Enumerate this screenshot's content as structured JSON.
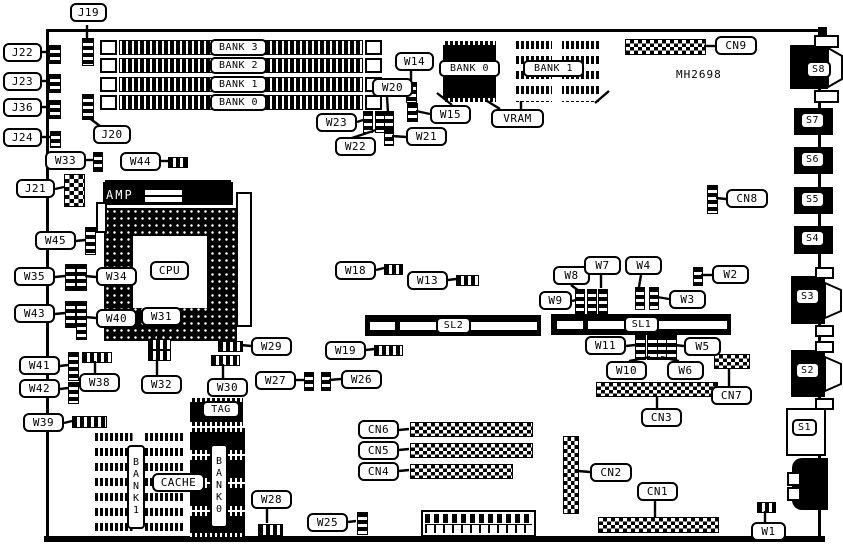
{
  "board": {
    "model": "MH2698"
  },
  "colors": {
    "foreground": "#000000",
    "background": "#ffffff"
  },
  "labels": {
    "j19": "J19",
    "j20": "J20",
    "j21": "J21",
    "j22": "J22",
    "j23": "J23",
    "j24": "J24",
    "j36": "J36",
    "w1": "W1",
    "w2": "W2",
    "w3": "W3",
    "w4": "W4",
    "w5": "W5",
    "w6": "W6",
    "w7": "W7",
    "w8": "W8",
    "w9": "W9",
    "w10": "W10",
    "w11": "W11",
    "w13": "W13",
    "w14": "W14",
    "w15": "W15",
    "w18": "W18",
    "w19": "W19",
    "w20": "W20",
    "w21": "W21",
    "w22": "W22",
    "w23": "W23",
    "w25": "W25",
    "w26": "W26",
    "w27": "W27",
    "w28": "W28",
    "w29": "W29",
    "w30": "W30",
    "w31": "W31",
    "w32": "W32",
    "w33": "W33",
    "w34": "W34",
    "w35": "W35",
    "w38": "W38",
    "w39": "W39",
    "w40": "W40",
    "w41": "W41",
    "w42": "W42",
    "w43": "W43",
    "w44": "W44",
    "w45": "W45",
    "cn1": "CN1",
    "cn2": "CN2",
    "cn3": "CN3",
    "cn4": "CN4",
    "cn5": "CN5",
    "cn6": "CN6",
    "cn7": "CN7",
    "cn8": "CN8",
    "cn9": "CN9",
    "s1": "S1",
    "s2": "S2",
    "s3": "S3",
    "s4": "S4",
    "s5": "S5",
    "s6": "S6",
    "s7": "S7",
    "s8": "S8",
    "sl1": "SL1",
    "sl2": "SL2",
    "simm_bank3": "BANK 3",
    "simm_bank2": "BANK 2",
    "simm_bank1": "BANK 1",
    "simm_bank0": "BANK 0",
    "vram_bank0": "BANK 0",
    "vram_bank1": "BANK 1",
    "vram": "VRAM",
    "cpu": "CPU",
    "amp": "AMP",
    "tag": "TAG",
    "cache": "CACHE",
    "cache_bank1": "BANK1",
    "cache_bank0": "BANK0"
  }
}
